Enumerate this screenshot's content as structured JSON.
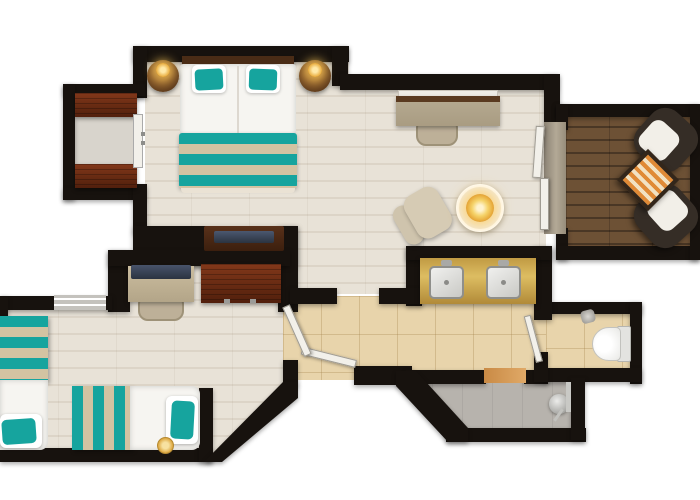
{
  "image_type": "hotel-suite-floor-plan",
  "floorplan": {
    "rooms": [
      {
        "name": "master-bedroom",
        "furniture": [
          "king-bed-with-teal-pillows",
          "teal-striped-foot-runner",
          "round-nightstand-left-with-lamp",
          "round-nightstand-right-with-lamp",
          "headboard",
          "tv-console",
          "closet-alcove-with-two-wood-dressers",
          "closet-sliding-door"
        ]
      },
      {
        "name": "living-area",
        "furniture": [
          "wall-desk",
          "desk-chair",
          "lounge-chair",
          "round-side-table-with-lit-lamp",
          "sliding-glass-door"
        ]
      },
      {
        "name": "balcony",
        "furniture": [
          "deck-chair-upper",
          "deck-chair-lower",
          "orange-striped-side-table",
          "dark-plank-decking"
        ]
      },
      {
        "name": "vanity-alcove",
        "furniture": [
          "gold-double-sink-vanity",
          "sink-left",
          "sink-right"
        ]
      },
      {
        "name": "hallway",
        "furniture": [
          "beige-floor-tiles",
          "entry-door",
          "door-to-second-bedroom",
          "door-to-toilet-room"
        ]
      },
      {
        "name": "toilet-room",
        "furniture": [
          "toilet",
          "paper-holder"
        ]
      },
      {
        "name": "shower-room",
        "furniture": [
          "gray-shower-floor",
          "shower-fixture",
          "wood-threshold",
          "glass-panel"
        ]
      },
      {
        "name": "second-bedroom",
        "furniture": [
          "twin-bed-left",
          "twin-bed-bottom",
          "desk-with-flat-tv",
          "desk-chair",
          "red-wood-dresser",
          "window",
          "small-gold-lamp"
        ]
      }
    ],
    "colors": {
      "wall": "#17120e",
      "wood-floor": "#e8e2d7",
      "wood-line": "#dcd4c7",
      "tile-floor": "#e8d4ab",
      "closet-floor": "#d8d4cc",
      "balcony-wood": "#6d5135",
      "balcony-wood-dark": "#4a3725",
      "teal": "#16a49e",
      "stripe-beige": "#d3c3a2",
      "dark-red-wood": "#511f0c",
      "dark-red-wood-light": "#82381a",
      "gold-counter": "#c09a43",
      "gold-counter-light": "#ddbd62",
      "lamp-gold": "#e8ab3c",
      "lamp-glow": "#ffe9a8",
      "shower-gray": "#b7b3ad",
      "cushion-white": "#f2efe8",
      "chair-dark": "#352d26",
      "table-orange": "#e08a36",
      "tan-furniture": "#bdb098",
      "mattress-white": "#f6f5f1",
      "tv-dark": "#2b3340",
      "silver": "#c9c9c5",
      "door-white": "#f2f0ea"
    }
  }
}
